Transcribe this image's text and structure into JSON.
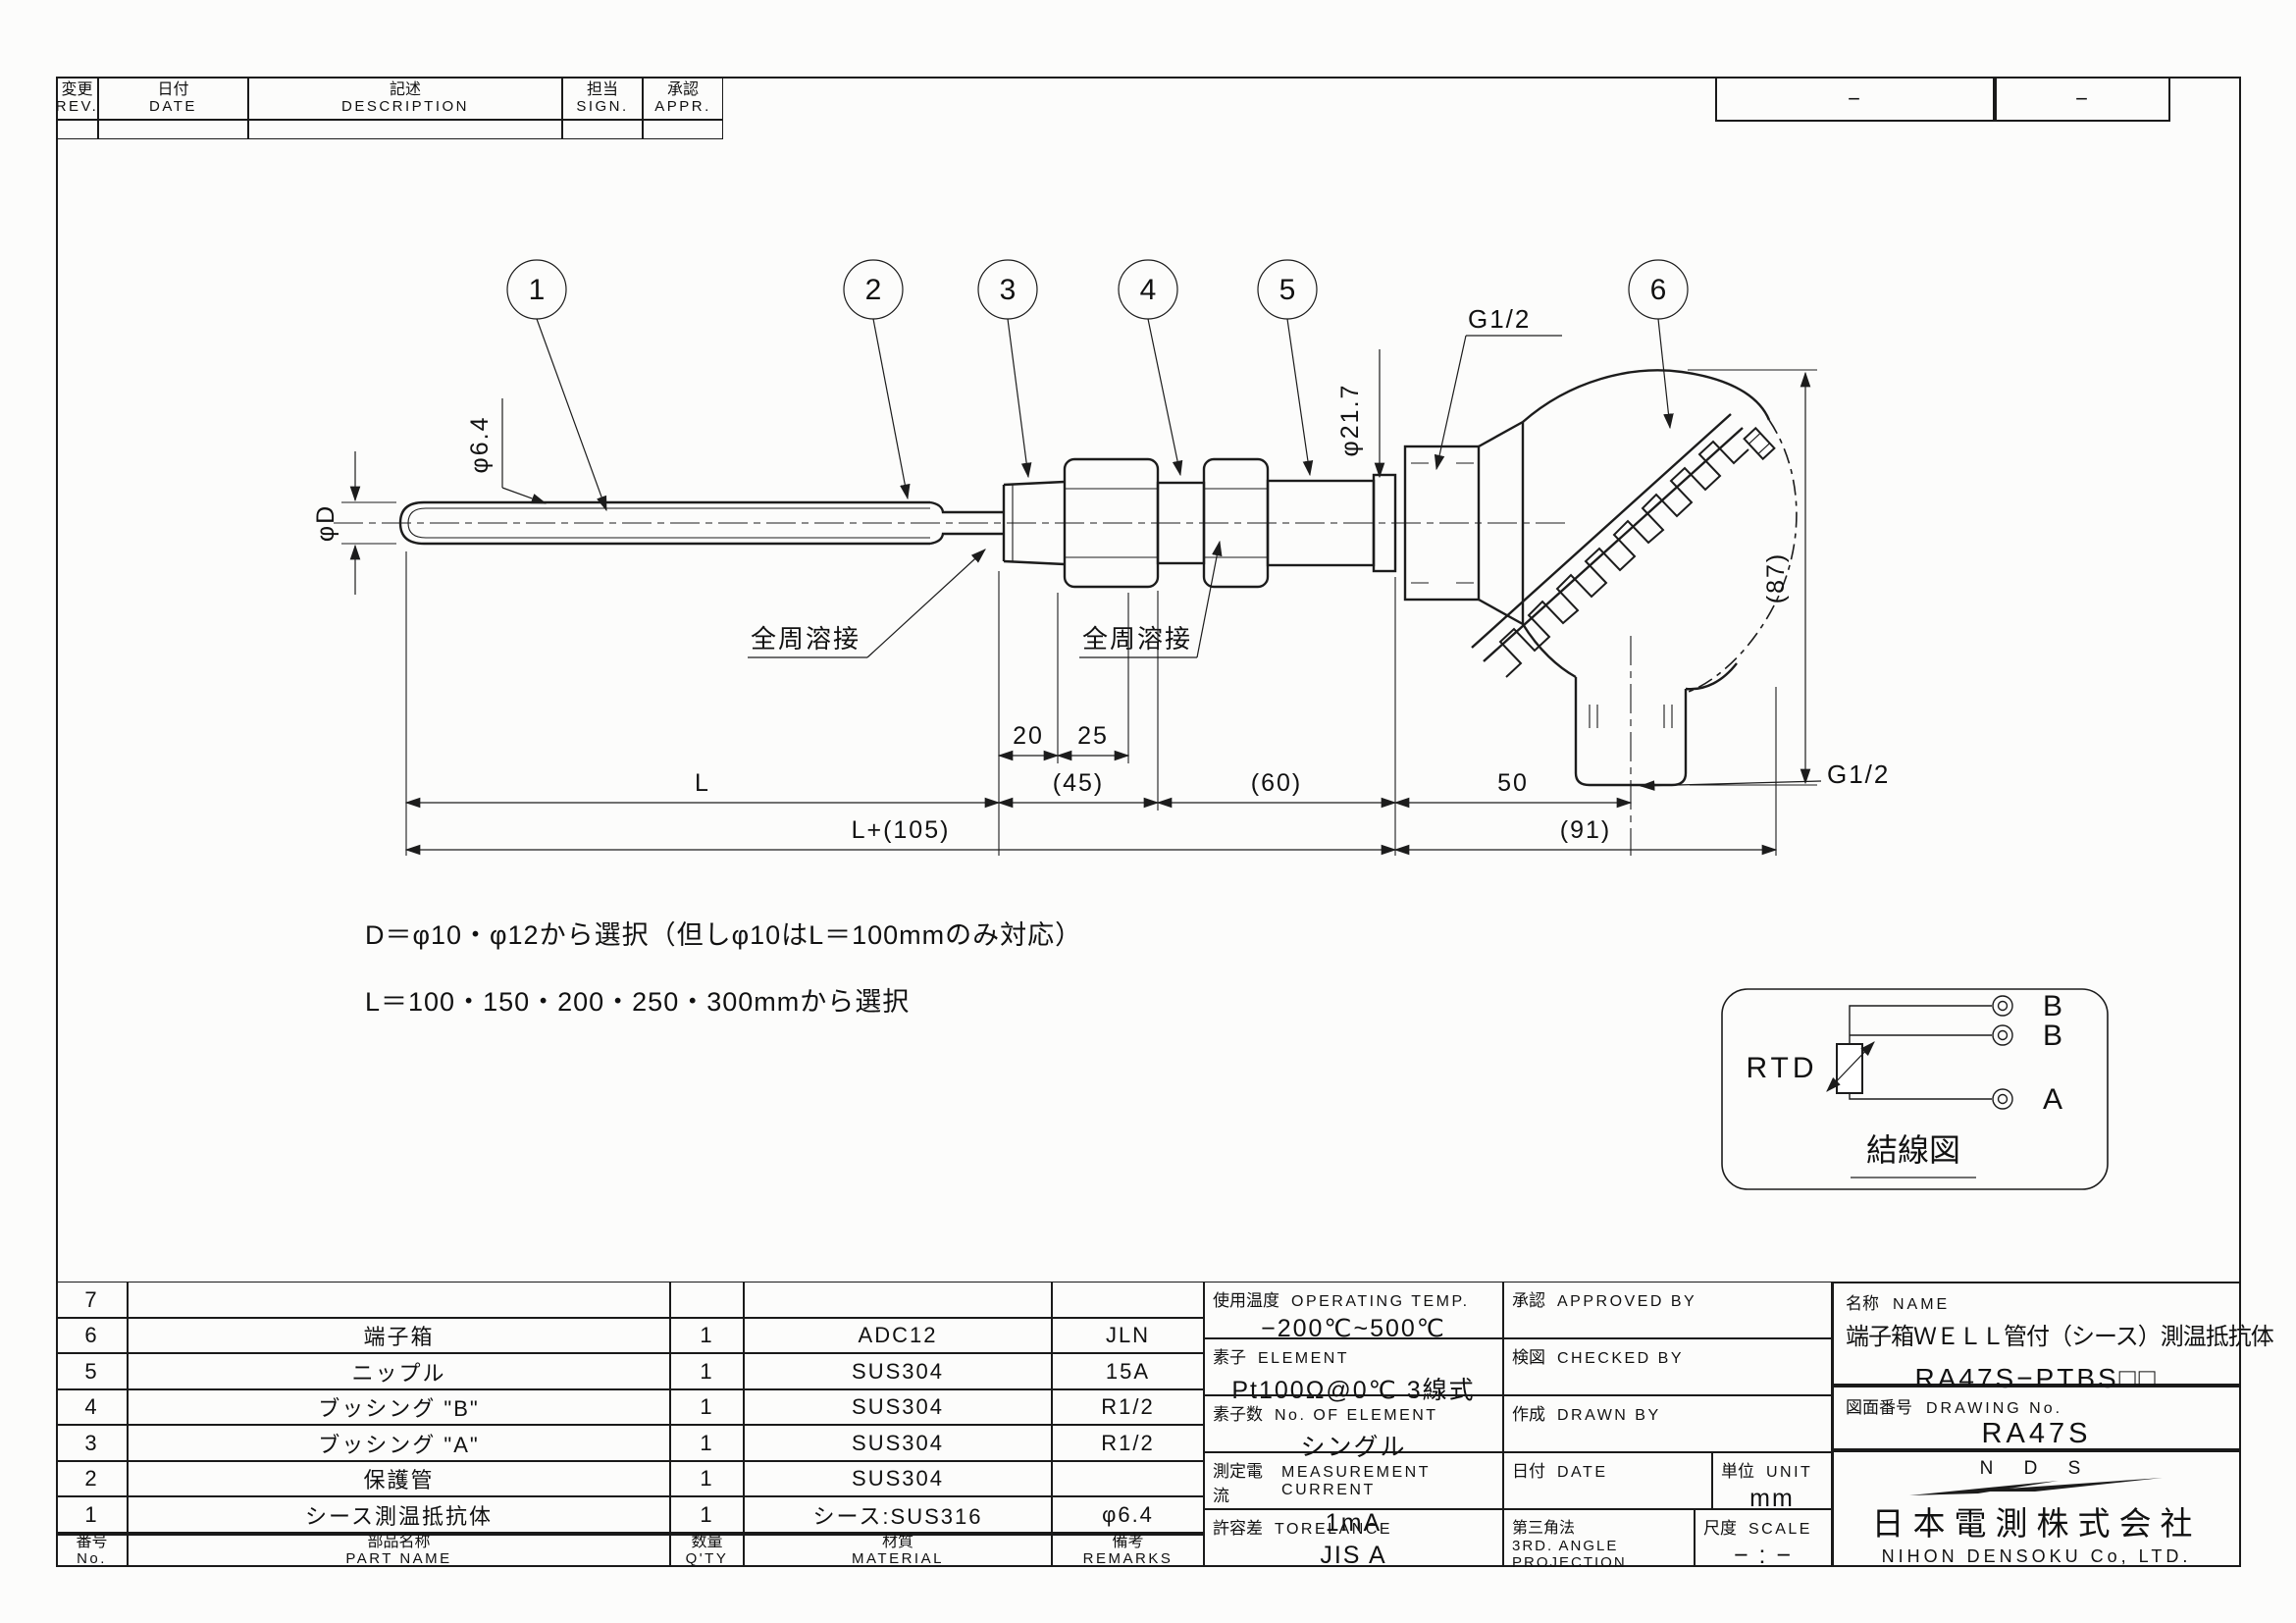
{
  "revision_table": {
    "headers": [
      {
        "jp": "変更",
        "en": "REV."
      },
      {
        "jp": "日付",
        "en": "DATE"
      },
      {
        "jp": "記述",
        "en": "DESCRIPTION"
      },
      {
        "jp": "担当",
        "en": "SIGN."
      },
      {
        "jp": "承認",
        "en": "APPR."
      }
    ]
  },
  "top_right": {
    "cell1": "−",
    "cell2": "−"
  },
  "drawing": {
    "balloons": [
      "1",
      "2",
      "3",
      "4",
      "5",
      "6"
    ],
    "labels": {
      "phi_d": "φD",
      "phi64": "φ6.4",
      "phi217": "φ21.7",
      "g12_top": "G1/2",
      "g12_bottom": "G1/2",
      "weld1": "全周溶接",
      "weld2": "全周溶接",
      "dim87": "(87)"
    },
    "dims": {
      "d20": "20",
      "d25": "25",
      "d45": "(45)",
      "d60": "(60)",
      "d50": "50",
      "dL": "L",
      "dL105": "L+(105)",
      "d91": "(91)"
    },
    "notes": [
      "D＝φ10・φ12から選択（但しφ10はL＝100mmのみ対応）",
      "L＝100・150・200・250・300mmから選択"
    ]
  },
  "wiring": {
    "rtd": "RTD",
    "terminals": [
      "B",
      "B",
      "A"
    ],
    "caption": "結線図"
  },
  "parts_table": {
    "header": {
      "no_jp": "番号",
      "no_en": "No.",
      "name_jp": "部品名称",
      "name_en": "PART NAME",
      "qty_jp": "数量",
      "qty_en": "Q'TY",
      "mat_jp": "材質",
      "mat_en": "MATERIAL",
      "rem_jp": "備考",
      "rem_en": "REMARKS"
    },
    "rows": [
      {
        "no": "7",
        "name": "",
        "qty": "",
        "material": "",
        "remarks": ""
      },
      {
        "no": "6",
        "name": "端子箱",
        "qty": "1",
        "material": "ADC12",
        "remarks": "JLN"
      },
      {
        "no": "5",
        "name": "ニップル",
        "qty": "1",
        "material": "SUS304",
        "remarks": "15A"
      },
      {
        "no": "4",
        "name": "ブッシング \"B\"",
        "qty": "1",
        "material": "SUS304",
        "remarks": "R1/2"
      },
      {
        "no": "3",
        "name": "ブッシング \"A\"",
        "qty": "1",
        "material": "SUS304",
        "remarks": "R1/2"
      },
      {
        "no": "2",
        "name": "保護管",
        "qty": "1",
        "material": "SUS304",
        "remarks": ""
      },
      {
        "no": "1",
        "name": "シース測温抵抗体",
        "qty": "1",
        "material": "シース:SUS316",
        "remarks": "φ6.4"
      }
    ]
  },
  "spec_table": {
    "operating_temp": {
      "label_jp": "使用温度",
      "label_en": "OPERATING TEMP.",
      "value": "−200℃~500℃"
    },
    "element": {
      "label_jp": "素子",
      "label_en": "ELEMENT",
      "value": "Pt100Ω@0℃ 3線式"
    },
    "num_element": {
      "label_jp": "素子数",
      "label_en": "No. OF ELEMENT",
      "value": "シングル"
    },
    "current": {
      "label_jp": "測定電流",
      "label_en": "MEASUREMENT CURRENT",
      "value": "1mA"
    },
    "tolerance": {
      "label_jp": "許容差",
      "label_en": "TORELANCE",
      "value": "JIS A"
    },
    "approved": {
      "label_jp": "承認",
      "label_en": "APPROVED BY"
    },
    "checked": {
      "label_jp": "検図",
      "label_en": "CHECKED BY"
    },
    "drawn": {
      "label_jp": "作成",
      "label_en": "DRAWN BY"
    },
    "date": {
      "label_jp": "日付",
      "label_en": "DATE"
    },
    "unit": {
      "label_jp": "単位",
      "label_en": "UNIT",
      "value": "mm"
    },
    "projection": {
      "label_jp": "第三角法",
      "label_en1": "3RD. ANGLE",
      "label_en2": "PROJECTION"
    },
    "scale": {
      "label_jp": "尺度",
      "label_en": "SCALE",
      "value": "− : −"
    }
  },
  "title_block": {
    "name_label_jp": "名称",
    "name_label_en": "NAME",
    "product_name": "端子箱ＷＥＬＬ管付（シース）測温抵抗体",
    "model": "RA47S−PTBS□□",
    "drawing_no_label_jp": "図面番号",
    "drawing_no_label_en": "DRAWING No.",
    "drawing_no": "RA47S",
    "logo_text": "N D S",
    "company_jp": "日本電測株式会社",
    "company_en": "NIHON DENSOKU Co, LTD."
  }
}
